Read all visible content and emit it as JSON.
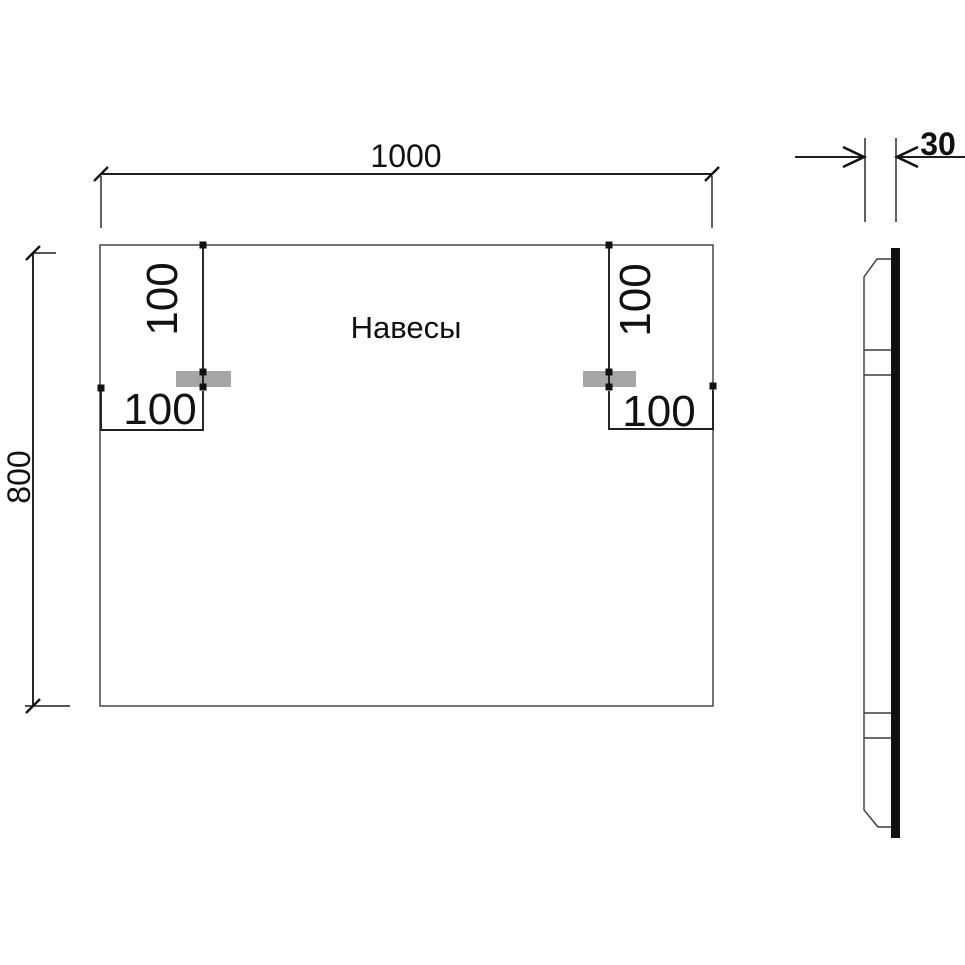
{
  "drawing": {
    "label": "Навесы",
    "front_view": {
      "overall_width": "1000",
      "overall_height": "800",
      "hanger_top_offset_left": "100",
      "hanger_top_offset_right": "100",
      "hanger_side_offset_left": "100",
      "hanger_side_offset_right": "100"
    },
    "side_view": {
      "thickness": "30"
    },
    "colors": {
      "line": "#1f1f1f",
      "object_line": "#3a3a3a",
      "bracket_fill": "#a6a6a6",
      "background": "#ffffff"
    }
  }
}
